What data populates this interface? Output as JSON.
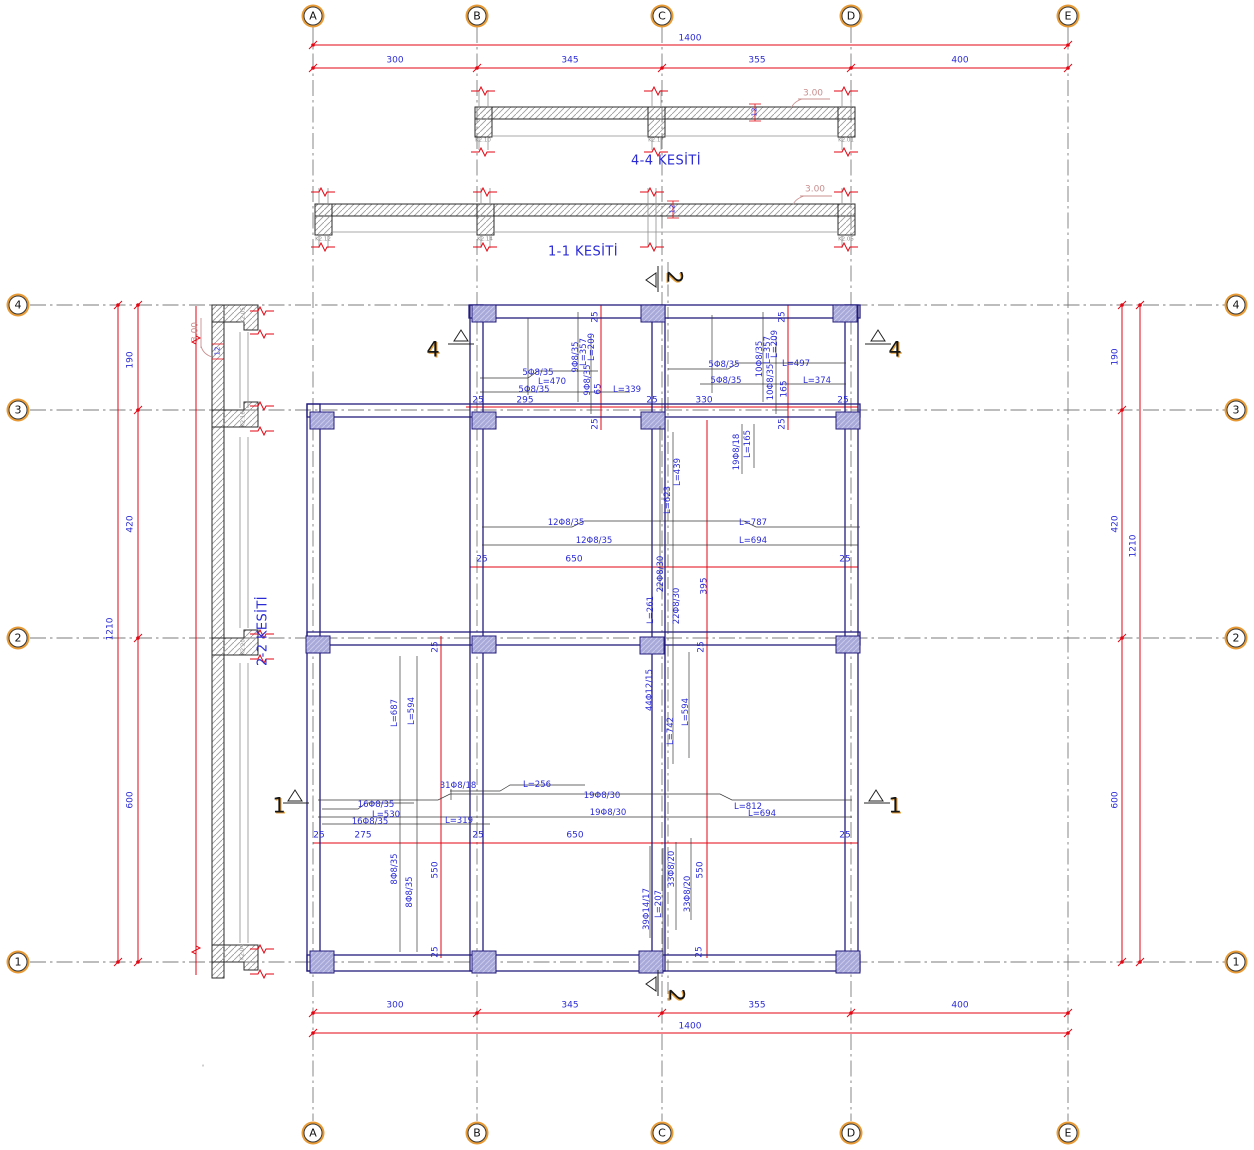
{
  "drawing": {
    "type": "reinforced-concrete-slab-plan-with-sections",
    "section_titles": {
      "s44": "4-4 KESİTİ",
      "s11": "1-1 KESİTİ",
      "s22": "2-2 KESİTİ"
    },
    "colors": {
      "dimension_red": "#e30613",
      "annotation_blue": "#2b2bd5",
      "beam_navy": "#241c7d",
      "column_fill": "#a9a9d9",
      "elevation_pink": "#c98f8f",
      "bubble_ring": "#e89a35"
    }
  },
  "grid": {
    "cols": [
      "A",
      "B",
      "C",
      "D",
      "E"
    ],
    "col_x": [
      313,
      477,
      662,
      851,
      1068
    ],
    "rows": [
      "4",
      "3",
      "2",
      "1"
    ],
    "row_y": [
      305,
      410,
      638,
      962
    ],
    "top_y": 16,
    "bottom_y": 1133,
    "left_x": 18,
    "right_x": 1236
  },
  "dimensions": {
    "horizontal_total": "1400",
    "horizontal_segments": [
      "300",
      "345",
      "355",
      "400"
    ],
    "vertical_total": "1210",
    "vertical_segments": [
      "190",
      "420",
      "600"
    ],
    "slab_elevation": "3.00",
    "slab_thickness": "12"
  },
  "labels": [
    {
      "t": "1400",
      "x": 690,
      "y": 39,
      "c": "dim"
    },
    {
      "t": "300",
      "x": 395,
      "y": 61,
      "c": "dim"
    },
    {
      "t": "345",
      "x": 570,
      "y": 61,
      "c": "dim"
    },
    {
      "t": "355",
      "x": 757,
      "y": 61,
      "c": "dim"
    },
    {
      "t": "400",
      "x": 960,
      "y": 61,
      "c": "dim"
    },
    {
      "t": "300",
      "x": 395,
      "y": 1006,
      "c": "dim"
    },
    {
      "t": "345",
      "x": 570,
      "y": 1006,
      "c": "dim"
    },
    {
      "t": "355",
      "x": 757,
      "y": 1006,
      "c": "dim"
    },
    {
      "t": "400",
      "x": 960,
      "y": 1006,
      "c": "dim"
    },
    {
      "t": "1400",
      "x": 690,
      "y": 1027,
      "c": "dim"
    },
    {
      "t": "190",
      "x": 131,
      "y": 360,
      "r": -90,
      "c": "dim"
    },
    {
      "t": "420",
      "x": 131,
      "y": 524,
      "r": -90,
      "c": "dim"
    },
    {
      "t": "600",
      "x": 131,
      "y": 800,
      "r": -90,
      "c": "dim"
    },
    {
      "t": "1210",
      "x": 111,
      "y": 629,
      "r": -90,
      "c": "dim"
    },
    {
      "t": "190",
      "x": 1116,
      "y": 357,
      "r": -90,
      "c": "dim"
    },
    {
      "t": "420",
      "x": 1116,
      "y": 524,
      "r": -90,
      "c": "dim"
    },
    {
      "t": "600",
      "x": 1116,
      "y": 800,
      "r": -90,
      "c": "dim"
    },
    {
      "t": "1210",
      "x": 1134,
      "y": 546,
      "r": -90,
      "c": "dim"
    },
    {
      "t": "25",
      "x": 478,
      "y": 401,
      "c": "dim"
    },
    {
      "t": "295",
      "x": 525,
      "y": 401,
      "c": "dim"
    },
    {
      "t": "25",
      "x": 652,
      "y": 401,
      "c": "dim"
    },
    {
      "t": "330",
      "x": 704,
      "y": 401,
      "c": "dim"
    },
    {
      "t": "25",
      "x": 843,
      "y": 401,
      "c": "dim"
    },
    {
      "t": "25",
      "x": 482,
      "y": 560,
      "c": "dim"
    },
    {
      "t": "650",
      "x": 574,
      "y": 560,
      "c": "dim"
    },
    {
      "t": "25",
      "x": 845,
      "y": 560,
      "c": "dim"
    },
    {
      "t": "25",
      "x": 319,
      "y": 836,
      "c": "dim"
    },
    {
      "t": "275",
      "x": 363,
      "y": 836,
      "c": "dim"
    },
    {
      "t": "25",
      "x": 478,
      "y": 836,
      "c": "dim"
    },
    {
      "t": "650",
      "x": 575,
      "y": 836,
      "c": "dim"
    },
    {
      "t": "25",
      "x": 845,
      "y": 836,
      "c": "dim"
    },
    {
      "t": "25",
      "x": 596,
      "y": 317,
      "r": -90,
      "c": "dim"
    },
    {
      "t": "25",
      "x": 783,
      "y": 317,
      "r": -90,
      "c": "dim"
    },
    {
      "t": "25",
      "x": 596,
      "y": 424,
      "r": -90,
      "c": "dim"
    },
    {
      "t": "25",
      "x": 783,
      "y": 424,
      "r": -90,
      "c": "dim"
    },
    {
      "t": "65",
      "x": 599,
      "y": 389,
      "r": -90,
      "c": "dim"
    },
    {
      "t": "165",
      "x": 785,
      "y": 389,
      "r": -90,
      "c": "dim"
    },
    {
      "t": "395",
      "x": 705,
      "y": 586,
      "r": -90,
      "c": "dim"
    },
    {
      "t": "25",
      "x": 436,
      "y": 647,
      "r": -90,
      "c": "dim"
    },
    {
      "t": "25",
      "x": 702,
      "y": 647,
      "r": -90,
      "c": "dim"
    },
    {
      "t": "550",
      "x": 436,
      "y": 870,
      "r": -90,
      "c": "dim"
    },
    {
      "t": "550",
      "x": 701,
      "y": 870,
      "r": -90,
      "c": "dim"
    },
    {
      "t": "25",
      "x": 436,
      "y": 952,
      "r": -90,
      "c": "dim"
    },
    {
      "t": "25",
      "x": 700,
      "y": 952,
      "r": -90,
      "c": "dim"
    },
    {
      "t": "5Φ8/35",
      "x": 538,
      "y": 373,
      "c": "rebar"
    },
    {
      "t": "L=470",
      "x": 552,
      "y": 382,
      "c": "rebar"
    },
    {
      "t": "5Φ8/35",
      "x": 534,
      "y": 390,
      "c": "rebar"
    },
    {
      "t": "L=339",
      "x": 627,
      "y": 390,
      "c": "rebar"
    },
    {
      "t": "5Φ8/35",
      "x": 724,
      "y": 365,
      "c": "rebar"
    },
    {
      "t": "L=497",
      "x": 796,
      "y": 364,
      "c": "rebar"
    },
    {
      "t": "5Φ8/35",
      "x": 726,
      "y": 381,
      "c": "rebar"
    },
    {
      "t": "L=374",
      "x": 817,
      "y": 381,
      "c": "rebar"
    },
    {
      "t": "12Φ8/35",
      "x": 566,
      "y": 523,
      "c": "rebar"
    },
    {
      "t": "L=787",
      "x": 753,
      "y": 523,
      "c": "rebar"
    },
    {
      "t": "12Φ8/35",
      "x": 594,
      "y": 541,
      "c": "rebar"
    },
    {
      "t": "L=694",
      "x": 753,
      "y": 541,
      "c": "rebar"
    },
    {
      "t": "31Φ8/18",
      "x": 458,
      "y": 786,
      "c": "rebar"
    },
    {
      "t": "L=256",
      "x": 537,
      "y": 785,
      "c": "rebar"
    },
    {
      "t": "19Φ8/30",
      "x": 602,
      "y": 796,
      "c": "rebar"
    },
    {
      "t": "19Φ8/30",
      "x": 608,
      "y": 813,
      "c": "rebar"
    },
    {
      "t": "L=812",
      "x": 748,
      "y": 807,
      "c": "rebar"
    },
    {
      "t": "L=694",
      "x": 762,
      "y": 814,
      "c": "rebar"
    },
    {
      "t": "16Φ8/35",
      "x": 376,
      "y": 805,
      "c": "rebar"
    },
    {
      "t": "L=530",
      "x": 386,
      "y": 815,
      "c": "rebar"
    },
    {
      "t": "16Φ8/35",
      "x": 370,
      "y": 822,
      "c": "rebar"
    },
    {
      "t": "L=319",
      "x": 459,
      "y": 821,
      "c": "rebar"
    },
    {
      "t": "9Φ8/35",
      "x": 576,
      "y": 357,
      "r": -90,
      "c": "rebar"
    },
    {
      "t": "L=357",
      "x": 584,
      "y": 352,
      "r": -90,
      "c": "rebar"
    },
    {
      "t": "L=209",
      "x": 592,
      "y": 347,
      "r": -90,
      "c": "rebar"
    },
    {
      "t": "9Φ8/35",
      "x": 588,
      "y": 380,
      "r": -90,
      "c": "rebar"
    },
    {
      "t": "10Φ8/35",
      "x": 760,
      "y": 359,
      "r": -90,
      "c": "rebar"
    },
    {
      "t": "L=357",
      "x": 768,
      "y": 350,
      "r": -90,
      "c": "rebar"
    },
    {
      "t": "L=209",
      "x": 775,
      "y": 344,
      "r": -90,
      "c": "rebar"
    },
    {
      "t": "10Φ8/35",
      "x": 771,
      "y": 382,
      "r": -90,
      "c": "rebar"
    },
    {
      "t": "19Φ8/18",
      "x": 737,
      "y": 452,
      "r": -90,
      "c": "rebar"
    },
    {
      "t": "L=165",
      "x": 748,
      "y": 444,
      "r": -90,
      "c": "rebar"
    },
    {
      "t": "L=439",
      "x": 678,
      "y": 472,
      "r": -90,
      "c": "rebar"
    },
    {
      "t": "L=623",
      "x": 668,
      "y": 500,
      "r": -90,
      "c": "rebar"
    },
    {
      "t": "22Φ8/30",
      "x": 661,
      "y": 574,
      "r": -90,
      "c": "rebar"
    },
    {
      "t": "L=261",
      "x": 651,
      "y": 610,
      "r": -90,
      "c": "rebar"
    },
    {
      "t": "22Φ8/30",
      "x": 677,
      "y": 606,
      "r": -90,
      "c": "rebar"
    },
    {
      "t": "44Φ12/15",
      "x": 650,
      "y": 690,
      "r": -90,
      "c": "rebar"
    },
    {
      "t": "L=742",
      "x": 671,
      "y": 731,
      "r": -90,
      "c": "rebar"
    },
    {
      "t": "L=594",
      "x": 686,
      "y": 712,
      "r": -90,
      "c": "rebar"
    },
    {
      "t": "L=687",
      "x": 395,
      "y": 713,
      "r": -90,
      "c": "rebar"
    },
    {
      "t": "L=594",
      "x": 412,
      "y": 711,
      "r": -90,
      "c": "rebar"
    },
    {
      "t": "8Φ8/35",
      "x": 395,
      "y": 869,
      "r": -90,
      "c": "rebar"
    },
    {
      "t": "8Φ8/35",
      "x": 410,
      "y": 892,
      "r": -90,
      "c": "rebar"
    },
    {
      "t": "39Φ14/17",
      "x": 647,
      "y": 909,
      "r": -90,
      "c": "rebar"
    },
    {
      "t": "L=207",
      "x": 659,
      "y": 904,
      "r": -90,
      "c": "rebar"
    },
    {
      "t": "33Φ8/20",
      "x": 672,
      "y": 869,
      "r": -90,
      "c": "rebar"
    },
    {
      "t": "33Φ8/20",
      "x": 688,
      "y": 894,
      "r": -90,
      "c": "rebar"
    },
    {
      "t": "12",
      "x": 755,
      "y": 112,
      "r": -90,
      "c": "thk"
    },
    {
      "t": "12",
      "x": 673,
      "y": 209,
      "r": -90,
      "c": "thk"
    },
    {
      "t": "12",
      "x": 218,
      "y": 351,
      "r": -90,
      "c": "thk"
    },
    {
      "t": "3.00",
      "x": 813,
      "y": 94,
      "c": "pink"
    },
    {
      "t": "3.00",
      "x": 815,
      "y": 190,
      "c": "pink"
    },
    {
      "t": "3.00",
      "x": 196,
      "y": 332,
      "r": -90,
      "c": "pink"
    },
    {
      "t": "K2.10",
      "x": 483,
      "y": 141,
      "c": "tiny"
    },
    {
      "t": "K2.17",
      "x": 656,
      "y": 141,
      "c": "tiny"
    },
    {
      "t": "K2.01",
      "x": 846,
      "y": 141,
      "c": "tiny"
    },
    {
      "t": "K2.12",
      "x": 323,
      "y": 240,
      "c": "tiny"
    },
    {
      "t": "K2.14",
      "x": 485,
      "y": 240,
      "c": "tiny"
    },
    {
      "t": "K2.05",
      "x": 846,
      "y": 240,
      "c": "tiny"
    },
    {
      "t": "K2.05",
      "x": 244,
      "y": 315,
      "r": -90,
      "c": "tiny"
    },
    {
      "t": "K2.16",
      "x": 244,
      "y": 419,
      "r": -90,
      "c": "tiny"
    },
    {
      "t": "K2.20",
      "x": 244,
      "y": 647,
      "r": -90,
      "c": "tiny"
    },
    {
      "t": "K2.04",
      "x": 243,
      "y": 952,
      "r": -90,
      "c": "tiny"
    },
    {
      "t": "°",
      "x": 203,
      "y": 1068,
      "c": "tiny"
    },
    {
      "t": "4-4 KESİTİ",
      "x": 666,
      "y": 161,
      "c": "title"
    },
    {
      "t": "1-1 KESİTİ",
      "x": 583,
      "y": 252,
      "c": "title"
    },
    {
      "t": "2-2 KESİTİ",
      "x": 263,
      "y": 631,
      "r": -90,
      "c": "title"
    },
    {
      "t": "4",
      "x": 433,
      "y": 350,
      "c": "marker"
    },
    {
      "t": "4",
      "x": 895,
      "y": 350,
      "c": "marker"
    },
    {
      "t": "1",
      "x": 279,
      "y": 806,
      "c": "marker"
    },
    {
      "t": "1",
      "x": 895,
      "y": 806,
      "c": "marker"
    },
    {
      "t": "2",
      "x": 674,
      "y": 277,
      "r": 90,
      "c": "marker"
    },
    {
      "t": "2",
      "x": 676,
      "y": 995,
      "r": 90,
      "c": "marker"
    }
  ]
}
